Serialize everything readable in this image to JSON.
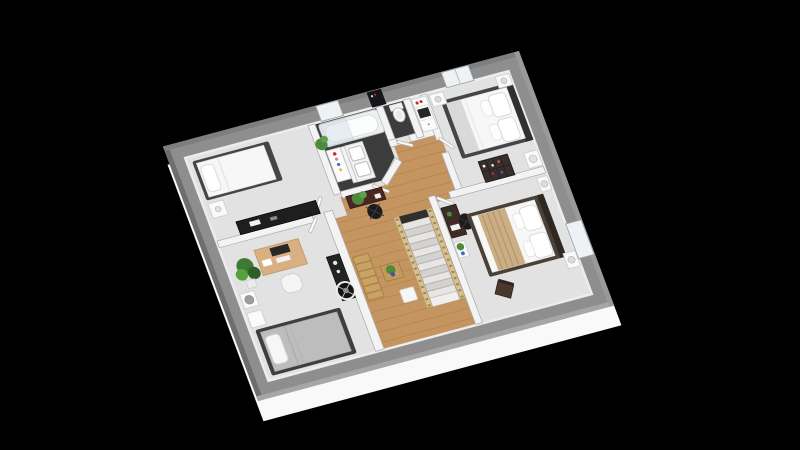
{
  "scene": {
    "type": "3d-floorplan-render",
    "view": "isometric",
    "floorplan": "upper floor with central landing and staircase leading down"
  },
  "palette": {
    "background": "#000000",
    "slab": "#f9f9f9",
    "outer_wall": "#8e8e8e",
    "outer_wall_dark_edge": "#6e6e6e",
    "outer_wall_light_edge": "#a6a6a6",
    "inner_wall": "#f3f3f3",
    "inner_wall_edge": "#ababab",
    "carpet": "#e2e2e2",
    "wood_floor": "#c49560",
    "wood_plank_line": "#aa7c44",
    "dark_tile": "#3c3c3c",
    "stair_rail": "#d8c292",
    "stair_step_light": "#e6e6e6",
    "stair_step_dark": "#d2d2d2",
    "white_furniture": "#fafafa",
    "dark_furniture": "#232323",
    "bed_frame": "#454545",
    "duvet_white": "#f7f7f7",
    "duvet_gray": "#bdbdbd",
    "blanket_tan": "#cbae83",
    "desk_wood": "#d8b084",
    "dark_wood": "#3e2c26",
    "plant_green": "#4e8a3c",
    "plant_green_light": "#61a04b",
    "accent_red": "#cc2a2a",
    "glass": "#cfdde8",
    "window": "#eef2f5"
  },
  "rooms": [
    {
      "id": "bedroom-1",
      "floor": "carpet",
      "furniture": [
        "single-bed",
        "nightstand",
        "tv-dresser"
      ]
    },
    {
      "id": "bathroom",
      "floor": "dark-tile",
      "furniture": [
        "bathtub",
        "glass-screen",
        "storage-cart",
        "double-sink-vanity",
        "plant"
      ]
    },
    {
      "id": "wc",
      "floor": "dark-tile",
      "furniture": [
        "toilet"
      ]
    },
    {
      "id": "hall-closet",
      "floor": "carpet",
      "furniture": [
        "shelf-cabinet"
      ]
    },
    {
      "id": "bedroom-2",
      "floor": "carpet",
      "furniture": [
        "double-bed",
        "nightstand-left",
        "nightstand-right",
        "bookshelf",
        "dresser-lamp-unit"
      ]
    },
    {
      "id": "bedroom-3",
      "floor": "carpet",
      "furniture": [
        "double-bed",
        "tan-throw-blanket",
        "nightstand-top",
        "nightstand-bottom",
        "desk",
        "desk-chair",
        "wall-shelf",
        "side-chair"
      ]
    },
    {
      "id": "office-bedroom",
      "floor": "carpet",
      "furniture": [
        "single-bed",
        "desk",
        "monitor",
        "desk-chair",
        "tall-plant",
        "lamp-table",
        "nightstand",
        "media-console",
        "pedestal-fan"
      ]
    },
    {
      "id": "landing-hallway",
      "floor": "wood",
      "furniture": [
        "staircase",
        "console-table",
        "console-plant",
        "office-chair",
        "slat-bench",
        "coffee-table",
        "coffee-table-plant",
        "white-stool"
      ]
    }
  ],
  "windows": [
    {
      "room": "bathroom",
      "wall": "top",
      "state": "closed"
    },
    {
      "room": "wc",
      "wall": "top",
      "state": "open-dark"
    },
    {
      "room": "bedroom-2",
      "wall": "top",
      "state": "closed"
    },
    {
      "room": "bedroom-3",
      "wall": "right",
      "state": "closed"
    }
  ]
}
